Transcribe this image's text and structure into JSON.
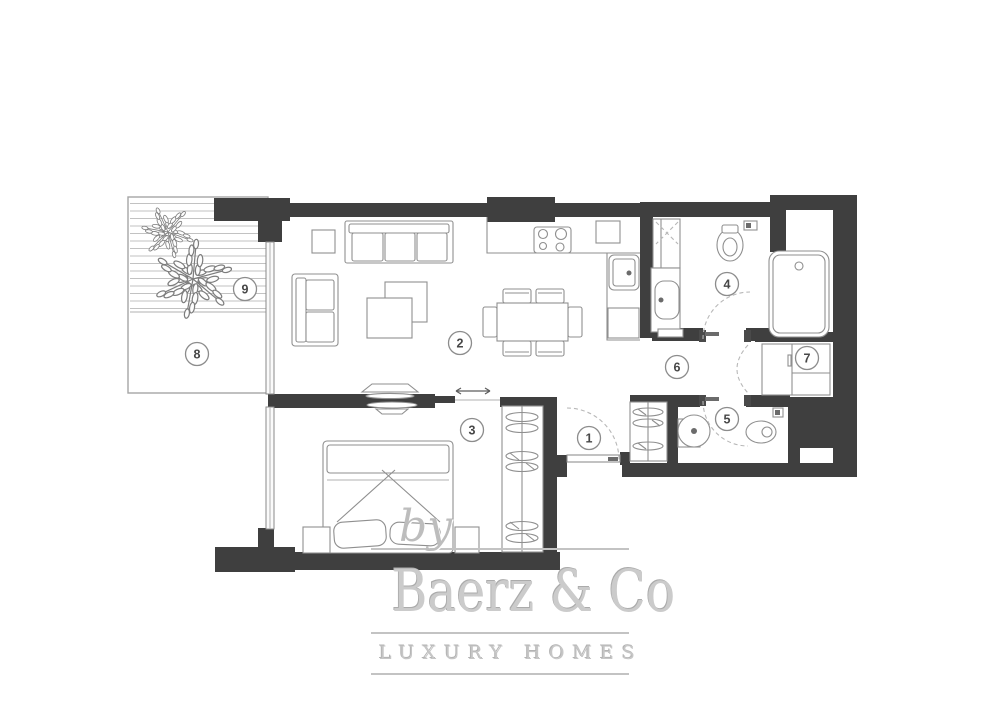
{
  "plan": {
    "room_labels": [
      {
        "id": "room-1",
        "number": "1"
      },
      {
        "id": "room-2",
        "number": "2"
      },
      {
        "id": "room-3",
        "number": "3"
      },
      {
        "id": "room-4",
        "number": "4"
      },
      {
        "id": "room-5",
        "number": "5"
      },
      {
        "id": "room-6",
        "number": "6"
      },
      {
        "id": "room-7",
        "number": "7"
      },
      {
        "id": "room-8",
        "number": "8"
      },
      {
        "id": "room-9",
        "number": "9"
      }
    ]
  },
  "watermark": {
    "by_text": "by",
    "brand": "Baerz & Co",
    "tagline": "LUXURY HOMES"
  },
  "colors": {
    "wall": "#3f3f3f",
    "furniture_line": "#8f8f8f",
    "label_text": "#474747",
    "watermark": "#c6c6c6",
    "background": "#ffffff"
  }
}
